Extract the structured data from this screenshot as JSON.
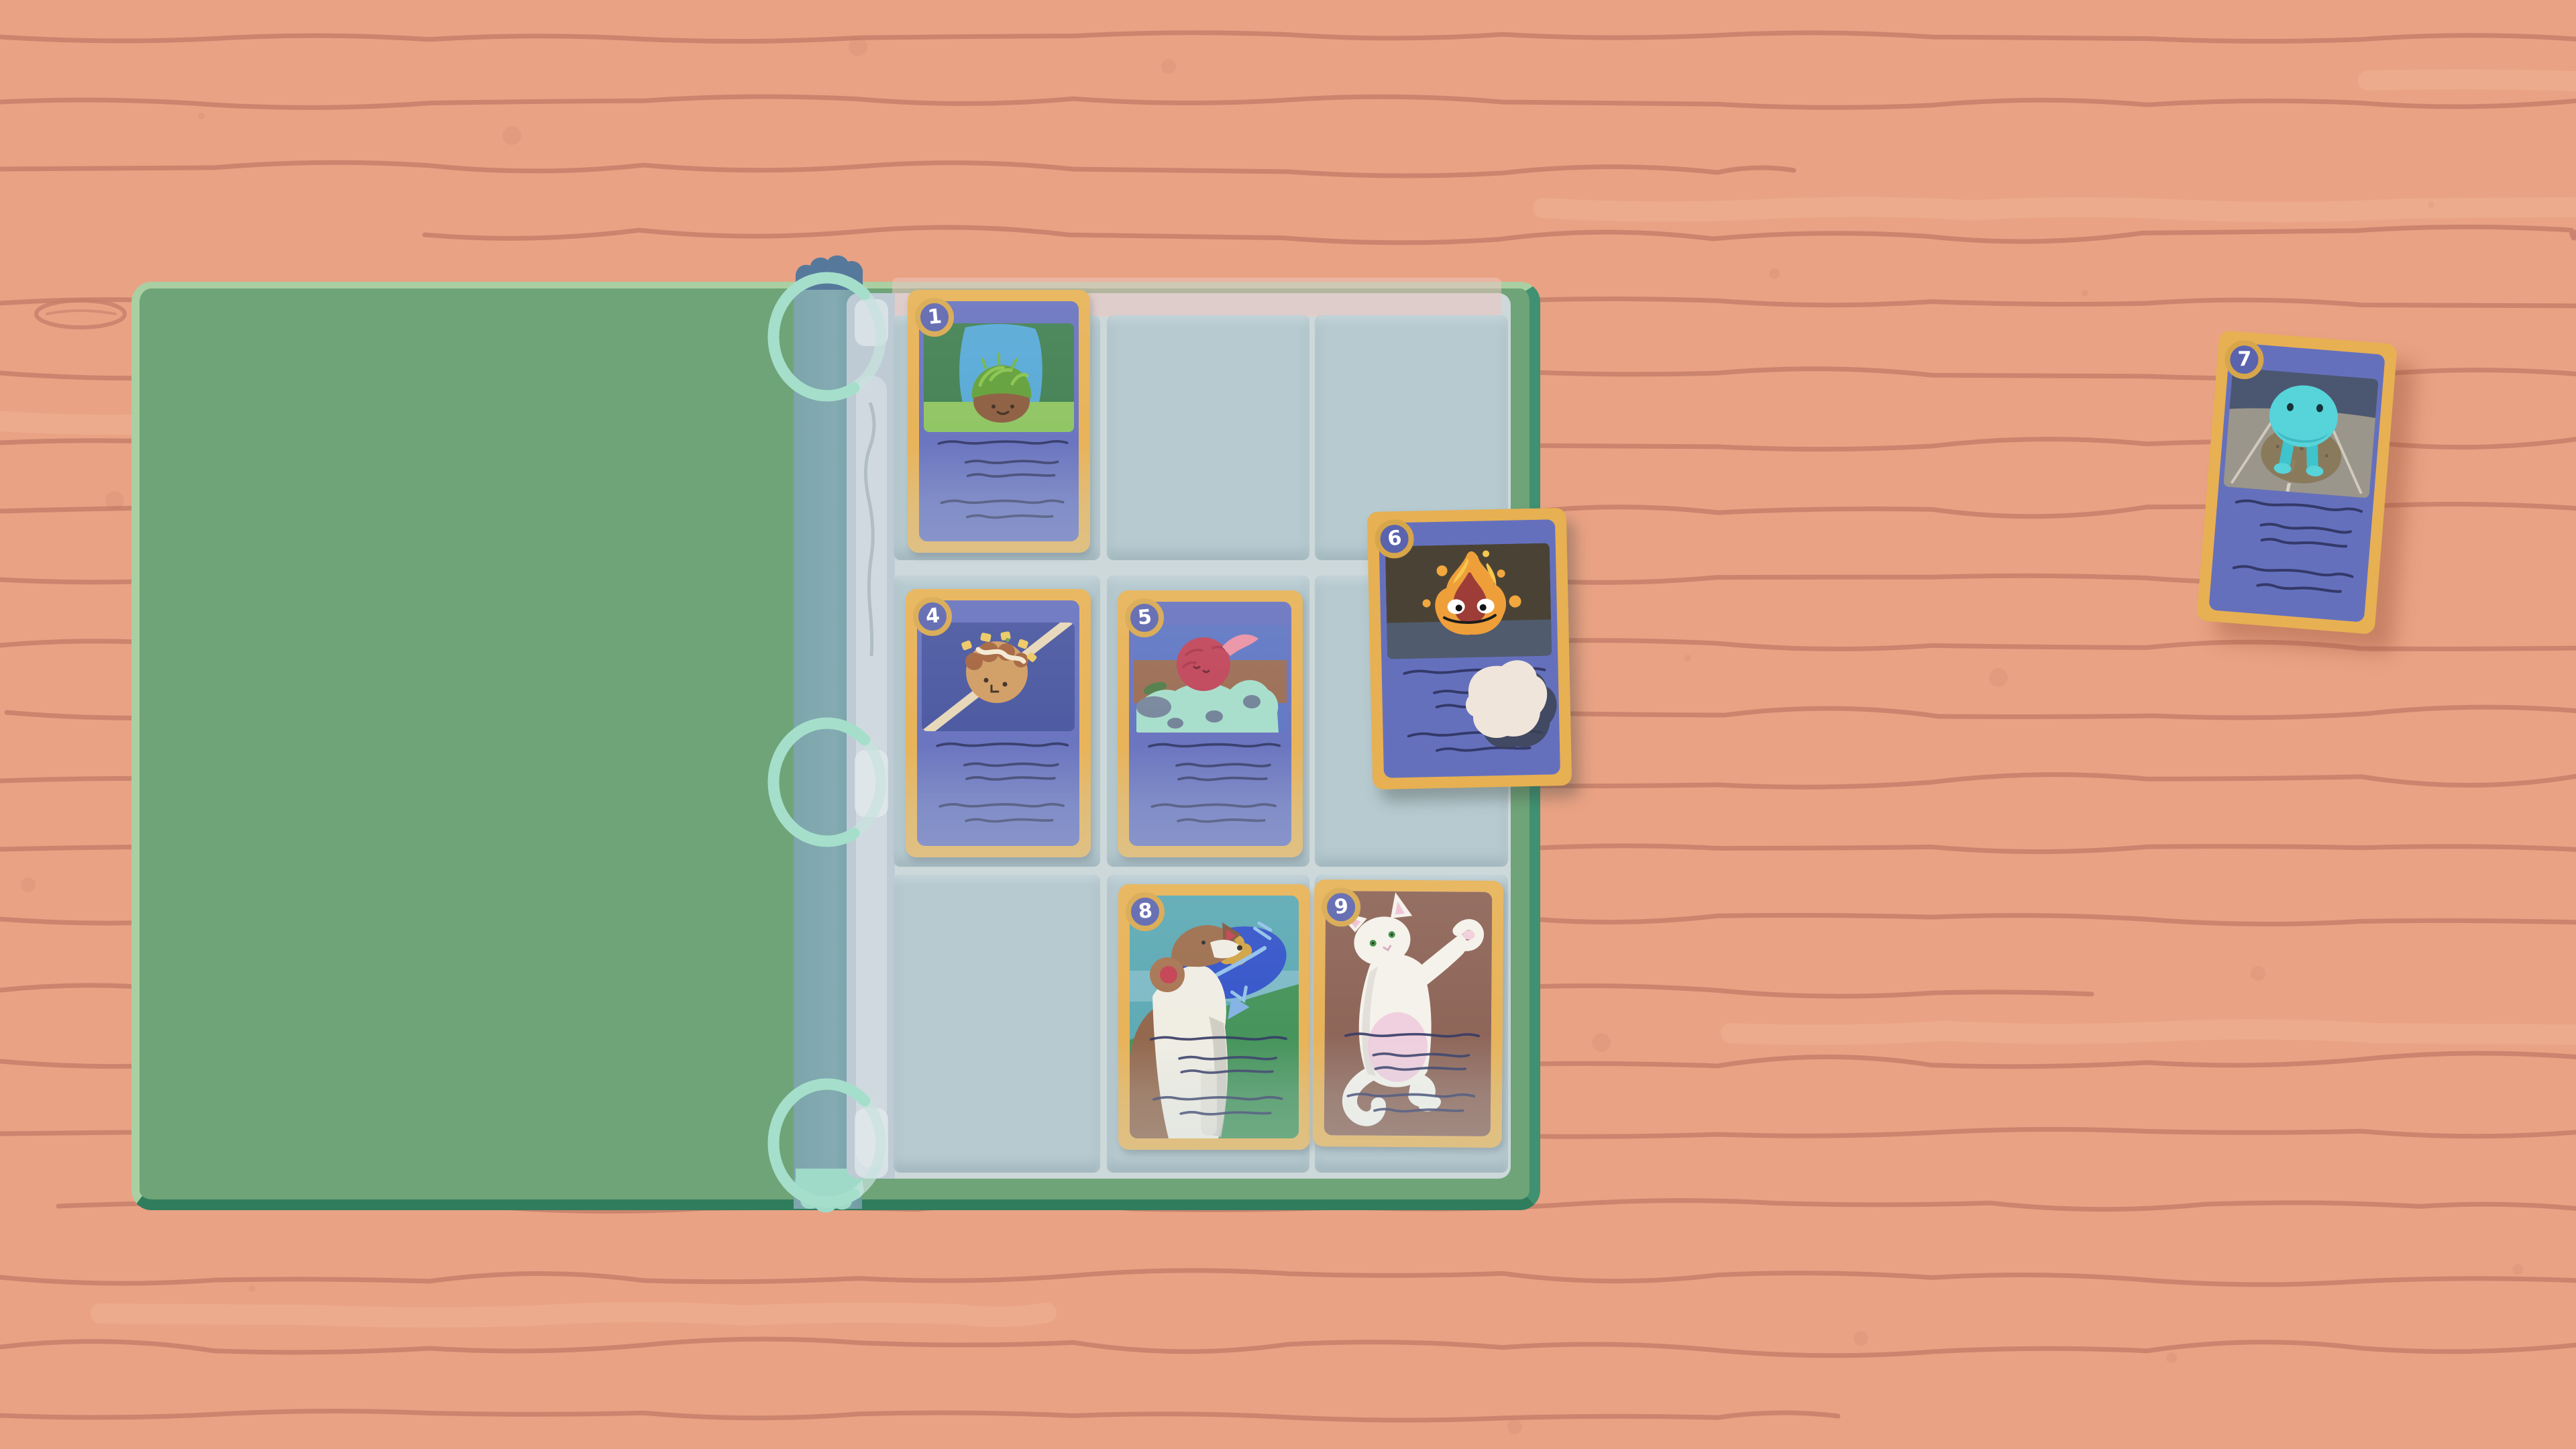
{
  "scene": {
    "environment": "wooden tabletop",
    "wood_base_color": "#e9a284",
    "wood_grain_color": "#c5806a",
    "wood_streak_color": "#f1b59c"
  },
  "binder": {
    "cover_color": "#6fa478",
    "cover_highlight_color": "#a9cfa2",
    "cover_trim_color": "#3f9171",
    "spine_color": "#81a9b0",
    "top_tab_color": "#56799b",
    "bottom_tab_color": "#9edac7",
    "ring_color": "#a5dfcb",
    "page_color": "#ccd8da",
    "pocket_color": "#b6cad0",
    "pocket_rows": 3,
    "pocket_cols": 3,
    "slots": [
      {
        "id": "r1c1",
        "card": "1"
      },
      {
        "id": "r1c2",
        "card": null
      },
      {
        "id": "r1c3",
        "card": null
      },
      {
        "id": "r2c1",
        "card": "4"
      },
      {
        "id": "r2c2",
        "card": "5"
      },
      {
        "id": "r2c3",
        "card": null
      },
      {
        "id": "r3c1",
        "card": null
      },
      {
        "id": "r3c2",
        "card": "8"
      },
      {
        "id": "r3c3",
        "card": "9"
      }
    ]
  },
  "card_style": {
    "border_color": "#e7b052",
    "face_color": "#6570bd",
    "badge_ring_color": "#d7a64b",
    "badge_fill_color": "#5a63ad",
    "badge_number_color": "#ffffff",
    "text_line_color": "#2e3460",
    "text_lines_per_card": 5
  },
  "cards": [
    {
      "number": "1",
      "subject": "grass-tuft-creature",
      "location": "binder-slot-r1c1"
    },
    {
      "number": "4",
      "subject": "takoyaki-skewer",
      "location": "binder-slot-r2c1"
    },
    {
      "number": "5",
      "subject": "beet-with-napping-creature",
      "location": "binder-slot-r2c2"
    },
    {
      "number": "6",
      "subject": "flame-spirit",
      "location": "loose-on-binder",
      "overlay": "white-blob"
    },
    {
      "number": "7",
      "subject": "teal-blob-creature",
      "location": "loose-on-table"
    },
    {
      "number": "8",
      "subject": "dog-with-fish-plush",
      "location": "binder-slot-r3c2"
    },
    {
      "number": "9",
      "subject": "white-cat",
      "location": "binder-slot-r3c3"
    }
  ]
}
